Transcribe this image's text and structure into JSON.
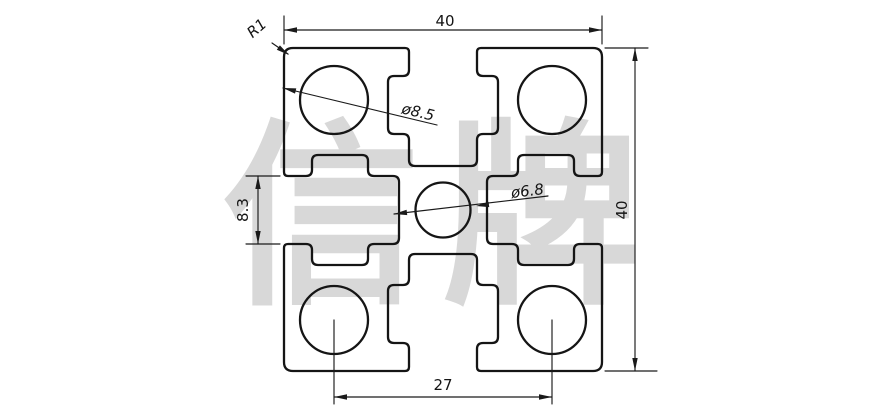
{
  "watermark": {
    "text": "信牌",
    "color": "#d8d8d8",
    "x": 222,
    "y": 286,
    "font_size": 198,
    "letter_spacing": 22
  },
  "colors": {
    "background": "#ffffff",
    "line": "#151515",
    "dimension": "#1a1a1a"
  },
  "profile": {
    "description_labels": [],
    "outline": [
      [
        284,
        48,
        9
      ],
      [
        409,
        48,
        4
      ],
      [
        409,
        76,
        6
      ],
      [
        388,
        76,
        6
      ],
      [
        388,
        134,
        6
      ],
      [
        409,
        134,
        6
      ],
      [
        409,
        166,
        6
      ],
      [
        477,
        166,
        6
      ],
      [
        477,
        134,
        6
      ],
      [
        498,
        134,
        6
      ],
      [
        498,
        76,
        6
      ],
      [
        477,
        76,
        6
      ],
      [
        477,
        48,
        4
      ],
      [
        602,
        48,
        9
      ],
      [
        602,
        176,
        4
      ],
      [
        574,
        176,
        6
      ],
      [
        574,
        155,
        6
      ],
      [
        518,
        155,
        6
      ],
      [
        518,
        176,
        6
      ],
      [
        487,
        176,
        6
      ],
      [
        487,
        244,
        6
      ],
      [
        518,
        244,
        6
      ],
      [
        518,
        265,
        6
      ],
      [
        574,
        265,
        6
      ],
      [
        574,
        244,
        6
      ],
      [
        602,
        244,
        4
      ],
      [
        602,
        371,
        9
      ],
      [
        477,
        371,
        4
      ],
      [
        477,
        343,
        6
      ],
      [
        498,
        343,
        6
      ],
      [
        498,
        285,
        6
      ],
      [
        477,
        285,
        6
      ],
      [
        477,
        254,
        6
      ],
      [
        409,
        254,
        6
      ],
      [
        409,
        285,
        6
      ],
      [
        388,
        285,
        6
      ],
      [
        388,
        343,
        6
      ],
      [
        409,
        343,
        6
      ],
      [
        409,
        371,
        4
      ],
      [
        284,
        371,
        9
      ],
      [
        284,
        244,
        4
      ],
      [
        312,
        244,
        6
      ],
      [
        312,
        265,
        6
      ],
      [
        368,
        265,
        6
      ],
      [
        368,
        244,
        6
      ],
      [
        399,
        244,
        6
      ],
      [
        399,
        176,
        6
      ],
      [
        368,
        176,
        6
      ],
      [
        368,
        155,
        6
      ],
      [
        312,
        155,
        6
      ],
      [
        312,
        176,
        6
      ],
      [
        284,
        176,
        4
      ]
    ],
    "corner_holes": {
      "radius": 34,
      "centers": [
        [
          334,
          100
        ],
        [
          552,
          100
        ],
        [
          334,
          320
        ],
        [
          552,
          320
        ]
      ]
    },
    "center_hole": {
      "radius": 27.5,
      "center": [
        443,
        210
      ]
    },
    "stroke_width_outline": 2.3,
    "stroke_width_dim": 1.15
  },
  "dims": {
    "top_width": {
      "label": "40",
      "line": [
        284,
        30,
        602,
        30
      ],
      "ext": [
        [
          284,
          16,
          284,
          44
        ],
        [
          602,
          16,
          602,
          44
        ]
      ],
      "arrows": [
        [
          284,
          30,
          180
        ],
        [
          602,
          30,
          0
        ]
      ],
      "text_pos": [
        445,
        26
      ],
      "rot": 0
    },
    "right_height": {
      "label": "40",
      "line": [
        635,
        48,
        635,
        371
      ],
      "ext": [
        [
          605,
          48,
          648,
          48
        ],
        [
          605,
          371,
          657,
          371
        ]
      ],
      "arrows": [
        [
          635,
          48,
          -90
        ],
        [
          635,
          371,
          90
        ]
      ],
      "text_pos": [
        627,
        210
      ],
      "rot": -90
    },
    "slot_opening": {
      "label": "8.3",
      "line": [
        258,
        176,
        258,
        244
      ],
      "ext": [
        [
          246,
          176,
          280,
          176
        ],
        [
          246,
          244,
          280,
          244
        ]
      ],
      "arrows": [
        [
          258,
          176,
          -90
        ],
        [
          258,
          244,
          90
        ]
      ],
      "text_pos": [
        248,
        210
      ],
      "rot": -90
    },
    "hole_spacing": {
      "label": "27",
      "line": [
        334,
        397,
        552,
        397
      ],
      "ext": [
        [
          334,
          320,
          334,
          404
        ],
        [
          552,
          320,
          552,
          404
        ]
      ],
      "arrows": [
        [
          334,
          397,
          180
        ],
        [
          552,
          397,
          0
        ]
      ],
      "text_pos": [
        443,
        390
      ],
      "rot": 0
    },
    "corner_radius": {
      "label": "R1",
      "line": [
        272,
        43,
        288,
        54
      ],
      "ext": [],
      "arrows": [
        [
          289,
          55,
          35
        ]
      ],
      "text_pos": [
        260,
        32
      ],
      "rot": -41
    },
    "corner_hole": {
      "label": "ø8.5",
      "line": [
        283,
        88,
        437,
        125
      ],
      "ext": [],
      "arrows": [
        [
          283,
          88,
          193.5
        ]
      ],
      "text_pos": [
        417,
        117
      ],
      "rot": 13.5
    },
    "center_hole": {
      "label": "ø6.8",
      "line": [
        394,
        214,
        548,
        196
      ],
      "ext": [],
      "arrows": [
        [
          394,
          214,
          173.3
        ],
        [
          476,
          206,
          173.3
        ]
      ],
      "text_pos": [
        528,
        196
      ],
      "rot": -7
    }
  }
}
